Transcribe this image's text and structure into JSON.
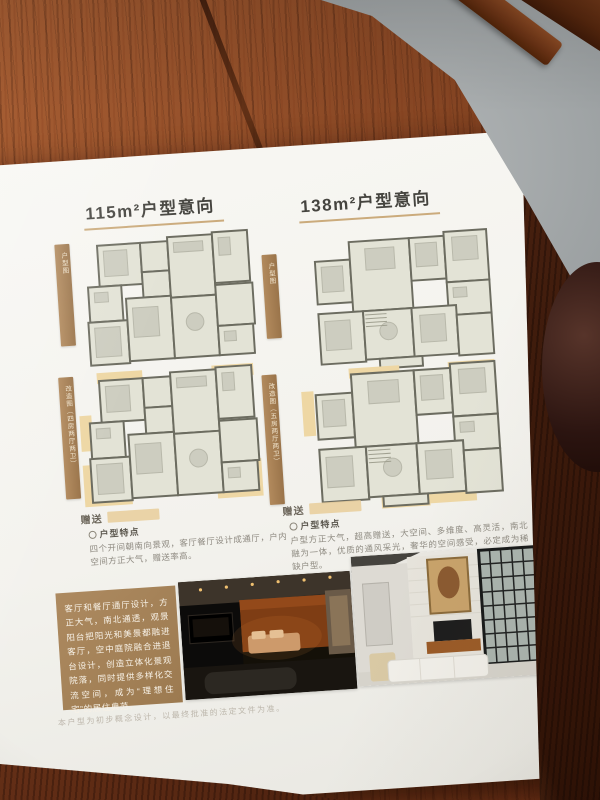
{
  "brochure": {
    "left": {
      "title": "115m²户型意向",
      "plan_labels": [
        "户型图",
        "改造图（四房两厅两卫）"
      ],
      "gift_label": "赠送",
      "features_heading": "户型特点",
      "features_text": "四个开间朝南向景观，客厅餐厅设计成通厅，户内空间方正大气，赠送率高。"
    },
    "right": {
      "title": "138m²户型意向",
      "plan_labels": [
        "户型图",
        "改造图（五房两厅两卫）"
      ],
      "gift_label": "赠送",
      "features_heading": "户型特点",
      "features_text": "户型方正大气，超高赠送，大空间、多维度、高灵活，南北融为一体，优质的通风采光，奢华的空间感受，必定成为稀缺户型。"
    },
    "description_box": "客厅和餐厅通厅设计，方正大气，南北通透，观景阳台把阳光和美景都融进客厅，空中庭院融合进退台设计，创造立体化景观院落，同时提供多样化交流空间，成为“理想住宅”的居住典范。",
    "footnote": "本户型为初步概念设计，以最终批准的法定文件为准。"
  },
  "colors": {
    "accent_tan": "#b28a5d",
    "gift_highlight": "#e9cf9e",
    "wood_table": "#8c4a26",
    "paper": "#f3f2ed",
    "floor_gray": "#8f9496"
  }
}
